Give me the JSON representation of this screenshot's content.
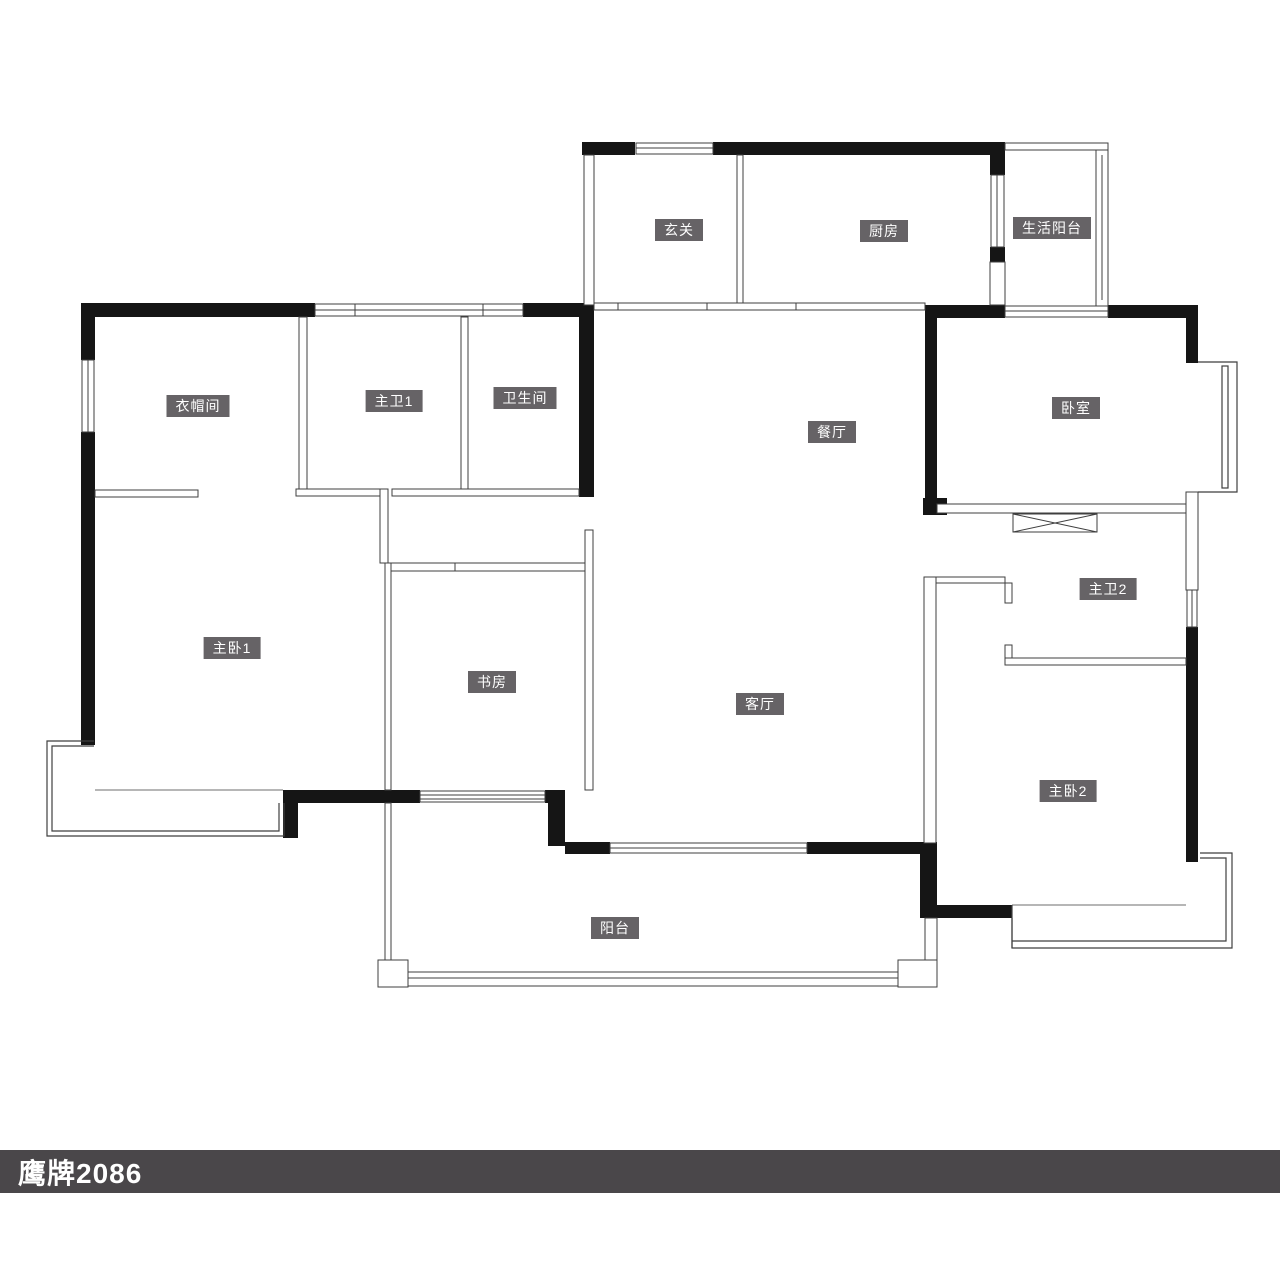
{
  "brand": {
    "label": "鹰牌2086"
  },
  "rooms": {
    "xuanguan": {
      "label": "玄关"
    },
    "chufang": {
      "label": "厨房"
    },
    "shenghuoyangtai": {
      "label": "生活阳台"
    },
    "yimaojian": {
      "label": "衣帽间"
    },
    "zhuwei1": {
      "label": "主卫1"
    },
    "weishengjian": {
      "label": "卫生间"
    },
    "canting": {
      "label": "餐厅"
    },
    "woshi": {
      "label": "卧室"
    },
    "zhuwo1": {
      "label": "主卧1"
    },
    "shufang": {
      "label": "书房"
    },
    "keting": {
      "label": "客厅"
    },
    "zhuwei2": {
      "label": "主卫2"
    },
    "zhuwo2": {
      "label": "主卧2"
    },
    "yangtai": {
      "label": "阳台"
    }
  },
  "colors": {
    "wall": "#151515",
    "thin_line": "#3f3f3f",
    "badge_bg": "#666366",
    "badge_text": "#ffffff",
    "brand_bar_bg": "#4a474a",
    "brand_bar_text": "#ffffff",
    "background": "#ffffff"
  }
}
